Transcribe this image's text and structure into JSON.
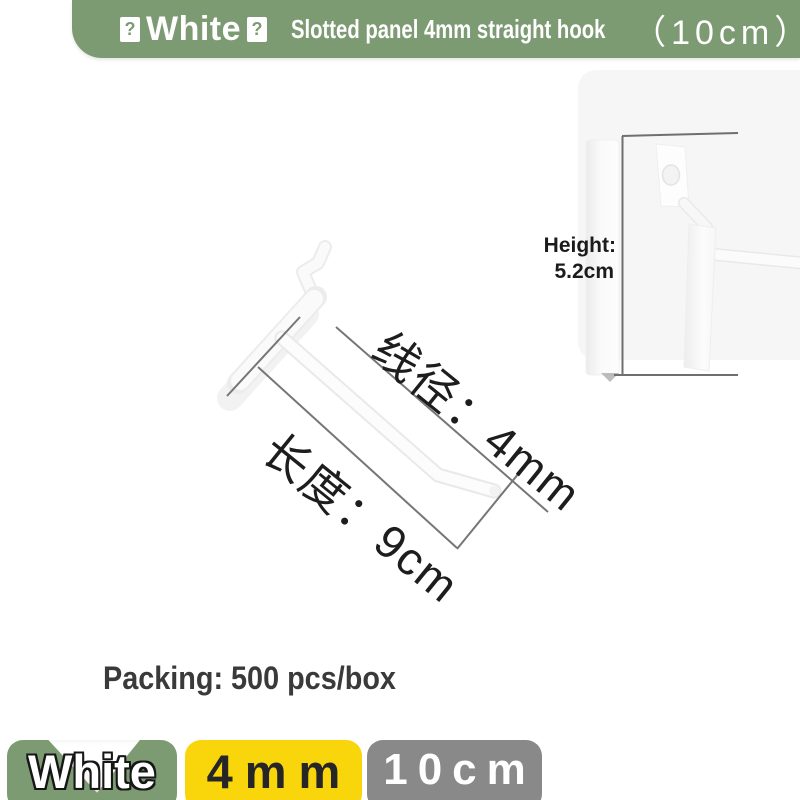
{
  "banner": {
    "bg_color": "#7d9b73",
    "missing_glyph": "?",
    "color_name": "White",
    "product_title": "Slotted panel 4mm straight hook",
    "size_note": "（10cm）"
  },
  "annotations": {
    "wire_diameter": "线径：4mm",
    "length": "长度：9cm",
    "height_label": "Height:",
    "height_value": "5.2cm"
  },
  "packing": "Packing: 500 pcs/box",
  "badges": {
    "color": {
      "label": "White",
      "bg": "#7d9b73"
    },
    "wire": {
      "label": "4mm",
      "bg": "#f9d60b"
    },
    "size": {
      "label": "10cm",
      "bg": "#898989"
    }
  }
}
